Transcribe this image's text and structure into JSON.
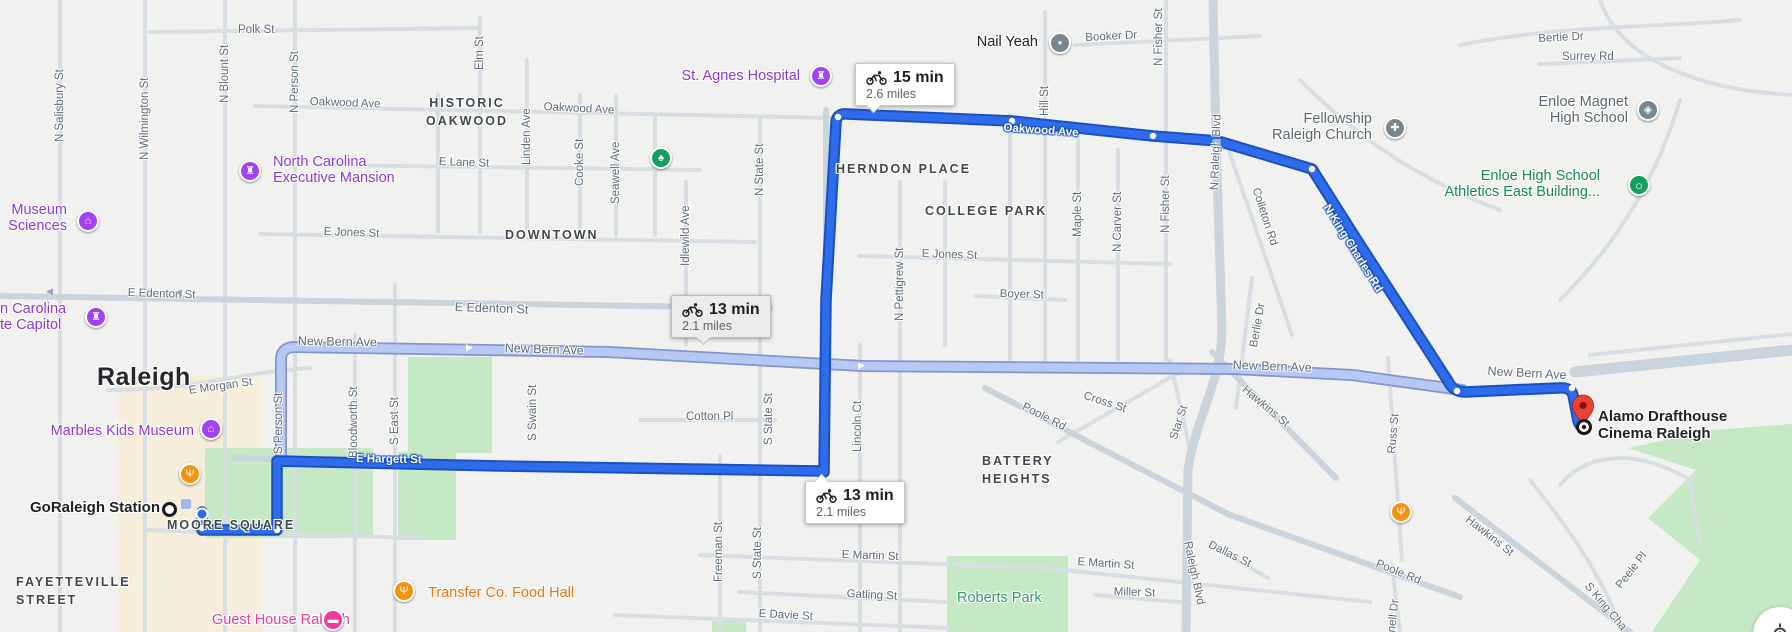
{
  "map": {
    "colors": {
      "route_primary": "#2e6ceb",
      "route_primary_casing": "#1b50c0",
      "route_alt": "#b7c8f5",
      "route_alt_casing": "#8496c9",
      "park_green": "#c5e8c5",
      "commercial_beige": "#f6eddb",
      "road": "#d7dee4",
      "road_major": "#c9d4dc",
      "poi_purple": "#8d36d9",
      "poi_green": "#15884e",
      "poi_gray": "#5b6770",
      "poi_orange": "#e8710a",
      "poi_pink": "#ef3a9b",
      "poi_black": "#202124",
      "park_label_green": "#2d9e68",
      "pin_purple": "#a142f4",
      "pin_gray": "#78878f",
      "pin_green": "#12a05c",
      "pin_orange": "#f4930c",
      "pin_pink": "#ef3a9b",
      "destination_red": "#ea4335"
    },
    "city_label": {
      "t": "Raleigh",
      "x": 97,
      "y": 363
    },
    "neighborhoods": [
      {
        "n": "historic-oakwood",
        "t": "HISTORIC\nOAKWOOD",
        "x": 412,
        "y": 94,
        "center": 110
      },
      {
        "n": "downtown",
        "t": "DOWNTOWN",
        "x": 505,
        "y": 226
      },
      {
        "n": "herndon-place",
        "t": "HERNDON PLACE",
        "x": 836,
        "y": 160
      },
      {
        "n": "college-park",
        "t": "COLLEGE PARK",
        "x": 925,
        "y": 202
      },
      {
        "n": "battery-heights",
        "t": "BATTERY\nHEIGHTS",
        "x": 982,
        "y": 452
      },
      {
        "n": "moore-square",
        "t": "MOORE SQUARE",
        "x": 167,
        "y": 516
      },
      {
        "n": "fayetteville-street",
        "t": "FAYETTEVILLE\nSTREET",
        "x": 16,
        "y": 573
      }
    ],
    "streets": [
      {
        "t": "Polk St",
        "x": 238,
        "y": 23
      },
      {
        "t": "N Salisbury St",
        "x": 53,
        "y": 142,
        "r": -90
      },
      {
        "t": "N Wilmington St",
        "x": 138,
        "y": 160,
        "r": -90
      },
      {
        "t": "N Blount St",
        "x": 218,
        "y": 103,
        "r": -90
      },
      {
        "t": "N Person St",
        "x": 288,
        "y": 113,
        "r": -90
      },
      {
        "t": "Elm St",
        "x": 473,
        "y": 70,
        "r": -90
      },
      {
        "t": "Linden Ave",
        "x": 520,
        "y": 165,
        "r": -90
      },
      {
        "t": "Cooke St",
        "x": 573,
        "y": 186,
        "r": -90
      },
      {
        "t": "Seawell Ave",
        "x": 609,
        "y": 204,
        "r": -90
      },
      {
        "t": "N State St",
        "x": 753,
        "y": 196,
        "r": -90
      },
      {
        "t": "Idlewild Ave",
        "x": 679,
        "y": 266,
        "r": -90
      },
      {
        "t": "N Pettigrew St",
        "x": 893,
        "y": 321,
        "r": -90
      },
      {
        "t": "Maple St",
        "x": 1071,
        "y": 237,
        "r": -90
      },
      {
        "t": "N Carver St",
        "x": 1111,
        "y": 252,
        "r": -90
      },
      {
        "t": "N Fisher St",
        "x": 1159,
        "y": 233,
        "r": -90
      },
      {
        "t": "N Fisher St",
        "x": 1152,
        "y": 66,
        "r": -90
      },
      {
        "t": "Hill St",
        "x": 1038,
        "y": 116,
        "r": -90
      },
      {
        "t": "N Raleigh Blvd",
        "x": 1208,
        "y": 190,
        "r": -88
      },
      {
        "t": "Booker Dr",
        "x": 1085,
        "y": 31,
        "r": -3
      },
      {
        "t": "Surrey Rd",
        "x": 1562,
        "y": 50
      },
      {
        "t": "Bertie Dr",
        "x": 1538,
        "y": 32,
        "r": -3
      },
      {
        "t": "Oakwood Ave",
        "x": 310,
        "y": 95,
        "r": 2
      },
      {
        "t": "Oakwood Ave",
        "x": 544,
        "y": 100,
        "r": 3
      },
      {
        "t": "E Lane St",
        "x": 439,
        "y": 155,
        "r": 2
      },
      {
        "t": "E Jones St",
        "x": 324,
        "y": 225,
        "r": 2
      },
      {
        "t": "E Jones St",
        "x": 922,
        "y": 247,
        "r": 2
      },
      {
        "t": "Boyer St",
        "x": 1000,
        "y": 287,
        "r": 2
      },
      {
        "t": "E Edenton St",
        "x": 128,
        "y": 286,
        "r": 2
      },
      {
        "t": "E Edenton St",
        "x": 455,
        "y": 300,
        "r": 2,
        "big": true
      },
      {
        "t": "New Bern Ave",
        "x": 298,
        "y": 334,
        "r": 1,
        "big": true
      },
      {
        "t": "New Bern Ave",
        "x": 505,
        "y": 341,
        "r": 2,
        "big": true
      },
      {
        "t": "New Bern Ave",
        "x": 1233,
        "y": 358,
        "r": 2,
        "big": true
      },
      {
        "t": "New Bern Ave",
        "x": 1488,
        "y": 364,
        "r": 3,
        "big": true
      },
      {
        "t": "E Morgan St",
        "x": 188,
        "y": 384,
        "r": -8
      },
      {
        "t": "Cotton Pl",
        "x": 686,
        "y": 410
      },
      {
        "t": "Bloodworth St",
        "x": 347,
        "y": 458,
        "r": -90
      },
      {
        "t": "S East St",
        "x": 388,
        "y": 445,
        "r": -90
      },
      {
        "t": "S Swain St",
        "x": 526,
        "y": 441,
        "r": -90
      },
      {
        "t": "S Person St",
        "x": 272,
        "y": 454,
        "r": -90
      },
      {
        "t": "S State St",
        "x": 762,
        "y": 445,
        "r": -90
      },
      {
        "t": "Lincoln Ct",
        "x": 851,
        "y": 452,
        "r": -90
      },
      {
        "t": "Freeman St",
        "x": 712,
        "y": 582,
        "r": -90
      },
      {
        "t": "S State St",
        "x": 751,
        "y": 579,
        "r": -90
      },
      {
        "t": "Russ St",
        "x": 1385,
        "y": 453,
        "r": -85
      },
      {
        "t": "Berlie Dr",
        "x": 1247,
        "y": 346,
        "r": -80
      },
      {
        "t": "Star St",
        "x": 1167,
        "y": 437,
        "r": -72
      },
      {
        "t": "Colleton Rd",
        "x": 1262,
        "y": 186,
        "r": 72
      },
      {
        "t": "Cross St",
        "x": 1086,
        "y": 389,
        "r": 18
      },
      {
        "t": "Hawkins St",
        "x": 1248,
        "y": 383,
        "r": 40
      },
      {
        "t": "Hawkins St",
        "x": 1471,
        "y": 513,
        "r": 38
      },
      {
        "t": "Poole Rd",
        "x": 1026,
        "y": 400,
        "r": 27
      },
      {
        "t": "Poole Rd",
        "x": 1379,
        "y": 557,
        "r": 22
      },
      {
        "t": "Dallas St",
        "x": 1212,
        "y": 538,
        "r": 26
      },
      {
        "t": "Raleigh Blvd",
        "x": 1194,
        "y": 540,
        "r": 78
      },
      {
        "t": "E Martin St",
        "x": 842,
        "y": 548,
        "r": 2
      },
      {
        "t": "E Martin St",
        "x": 1078,
        "y": 555,
        "r": 4
      },
      {
        "t": "Miller St",
        "x": 1114,
        "y": 585,
        "r": 2
      },
      {
        "t": "Gatling St",
        "x": 847,
        "y": 587,
        "r": 3
      },
      {
        "t": "E Davie St",
        "x": 759,
        "y": 607,
        "r": 3
      },
      {
        "t": "Peele Pl",
        "x": 1613,
        "y": 583,
        "r": -52
      },
      {
        "t": "S King Cha",
        "x": 1592,
        "y": 580,
        "r": 50
      },
      {
        "t": "Carnell Dr",
        "x": 1383,
        "y": 650,
        "r": -84
      },
      {
        "t": "E Hargett St",
        "x": 356,
        "y": 452,
        "r": 1,
        "onroute": true
      },
      {
        "t": "Oakwood Ave",
        "x": 1004,
        "y": 121,
        "r": 4,
        "onroute": true
      },
      {
        "t": "N King Charles Rd",
        "x": 1332,
        "y": 202,
        "r": 58,
        "onroute": true
      },
      {
        "t": "▶",
        "x": 466,
        "y": 342,
        "arrow": true,
        "c": "#ffffff"
      },
      {
        "t": "▶",
        "x": 858,
        "y": 360,
        "arrow": true,
        "c": "#ffffff"
      },
      {
        "t": "◀",
        "x": 46,
        "y": 286,
        "arrow": true,
        "c": "#9aa7b3"
      },
      {
        "t": "◀",
        "x": 175,
        "y": 287,
        "arrow": true,
        "c": "#9aa7b3"
      }
    ],
    "pois": [
      {
        "n": "museum-of-sciences",
        "t": "Museum\nSciences",
        "c": "poi_purple",
        "align": "right",
        "tx": 67,
        "ty": 203,
        "pin": {
          "k": "museum",
          "x": 88,
          "y": 221
        }
      },
      {
        "n": "nc-state-capitol",
        "t": "n Carolina\nte Capitol",
        "c": "poi_purple",
        "align": "left",
        "tx": 0,
        "ty": 302,
        "pin": {
          "k": "rook",
          "x": 96,
          "y": 317
        }
      },
      {
        "n": "nc-executive-mansion",
        "t": "North Carolina\nExecutive Mansion",
        "c": "poi_purple",
        "align": "left",
        "tx": 273,
        "ty": 155,
        "pin": {
          "k": "rook",
          "x": 250,
          "y": 171
        }
      },
      {
        "n": "st-agnes-hospital",
        "t": "St. Agnes Hospital",
        "c": "poi_purple",
        "align": "right",
        "tx": 800,
        "ty": 69,
        "pin": {
          "k": "rook",
          "x": 821,
          "y": 76
        }
      },
      {
        "n": "marbles-kids-museum",
        "t": "Marbles Kids Museum",
        "c": "poi_purple",
        "align": "right",
        "tx": 194,
        "ty": 424,
        "pin": {
          "k": "museum",
          "x": 211,
          "y": 429
        }
      },
      {
        "n": "nail-yeah",
        "t": "Nail Yeah",
        "c": "poi_black",
        "align": "right",
        "tx": 1038,
        "ty": 35,
        "pin": {
          "k": "dot",
          "x": 1060,
          "y": 43
        }
      },
      {
        "n": "fellowship-raleigh-church",
        "t": "Fellowship\nRaleigh Church",
        "c": "poi_gray",
        "align": "right",
        "tx": 1372,
        "ty": 112,
        "pin": {
          "k": "church",
          "x": 1395,
          "y": 128
        }
      },
      {
        "n": "enloe-magnet-high-school",
        "t": "Enloe Magnet\nHigh School",
        "c": "poi_gray",
        "align": "right",
        "tx": 1628,
        "ty": 95,
        "pin": {
          "k": "school",
          "x": 1648,
          "y": 110
        }
      },
      {
        "n": "enloe-athletics-east",
        "t": "Enloe High School\nAthletics East Building...",
        "c": "poi_green",
        "align": "right",
        "tx": 1600,
        "ty": 169,
        "pin": {
          "k": "ring",
          "x": 1639,
          "y": 185
        }
      },
      {
        "n": "roberts-park",
        "t": "Roberts Park",
        "c": "park_label_green",
        "align": "left",
        "tx": 957,
        "ty": 591
      },
      {
        "n": "transfer-co-food-hall",
        "t": "Transfer Co. Food Hall",
        "c": "poi_orange",
        "align": "left",
        "tx": 428,
        "ty": 586,
        "pin": {
          "k": "restaurant",
          "x": 404,
          "y": 591
        }
      },
      {
        "n": "guest-house-raleigh",
        "t": "Guest House Raleigh",
        "c": "poi_pink",
        "align": "left",
        "tx": 212,
        "ty": 613,
        "pin": {
          "k": "hotel",
          "x": 333,
          "y": 620
        }
      },
      {
        "n": "goraleigh-station",
        "t": "GoRaleigh Station",
        "c": "poi_black",
        "bold": true,
        "align": "right",
        "tx": 160,
        "ty": 500,
        "pin": {
          "k": "station",
          "x": 169,
          "y": 509
        }
      },
      {
        "n": "moore-square-restaurant",
        "t": "",
        "c": "poi_orange",
        "align": "left",
        "tx": 0,
        "ty": 0,
        "pin": {
          "k": "restaurant",
          "x": 190,
          "y": 474
        }
      },
      {
        "n": "hawkins-restaurant",
        "t": "",
        "c": "poi_orange",
        "align": "left",
        "tx": 0,
        "ty": 0,
        "pin": {
          "k": "restaurant",
          "x": 1401,
          "y": 512
        }
      },
      {
        "n": "oakwood-park-tree",
        "t": "",
        "c": "poi_green",
        "align": "left",
        "tx": 0,
        "ty": 0,
        "pin": {
          "k": "tree",
          "x": 661,
          "y": 158
        }
      },
      {
        "n": "moore-square-transit",
        "t": "",
        "c": "poi_black",
        "align": "left",
        "tx": 0,
        "ty": 0,
        "pin": {
          "k": "transit",
          "x": 186,
          "y": 504
        }
      },
      {
        "n": "alamo-drafthouse",
        "t": "Alamo Drafthouse\nCinema Raleigh",
        "c": "poi_black",
        "bold": true,
        "align": "left",
        "tx": 1598,
        "ty": 409
      }
    ],
    "pin_glyphs": {
      "rook": "♜",
      "museum": "⌂",
      "tree": "♠",
      "church": "✚",
      "school": "◈",
      "dot": "●",
      "ring": "○",
      "restaurant": "Ψ",
      "hotel": "▬"
    },
    "badges": [
      {
        "n": "route-badge-15min",
        "time": "15 min",
        "dist": "2.6 miles",
        "x": 855,
        "y": 63,
        "style": "primary",
        "tail": "down",
        "tail_left": 12
      },
      {
        "n": "route-badge-alt-13min",
        "time": "13 min",
        "dist": "2.1 miles",
        "x": 671,
        "y": 295,
        "style": "alt",
        "tail": "down",
        "tail_left": 26
      },
      {
        "n": "route-badge-13min",
        "time": "13 min",
        "dist": "2.1 miles",
        "x": 805,
        "y": 481,
        "style": "primary",
        "tail": "up",
        "tail_left": 10
      }
    ],
    "markers": {
      "start": {
        "n": "route-start-marker",
        "x": 202,
        "y": 514
      },
      "destination_pin": {
        "n": "destination-pin",
        "x": 1583,
        "y": 424
      },
      "destination_target": {
        "n": "destination-target",
        "x": 1584,
        "y": 427
      }
    },
    "route_dots": [
      [
        277,
        530
      ],
      [
        838,
        117
      ],
      [
        1012,
        121
      ],
      [
        1153,
        136
      ],
      [
        1312,
        169
      ],
      [
        1457,
        391
      ],
      [
        1572,
        388
      ],
      [
        202,
        528
      ],
      [
        202,
        514
      ]
    ],
    "ui": {
      "locate_button": "my-location-button"
    }
  }
}
